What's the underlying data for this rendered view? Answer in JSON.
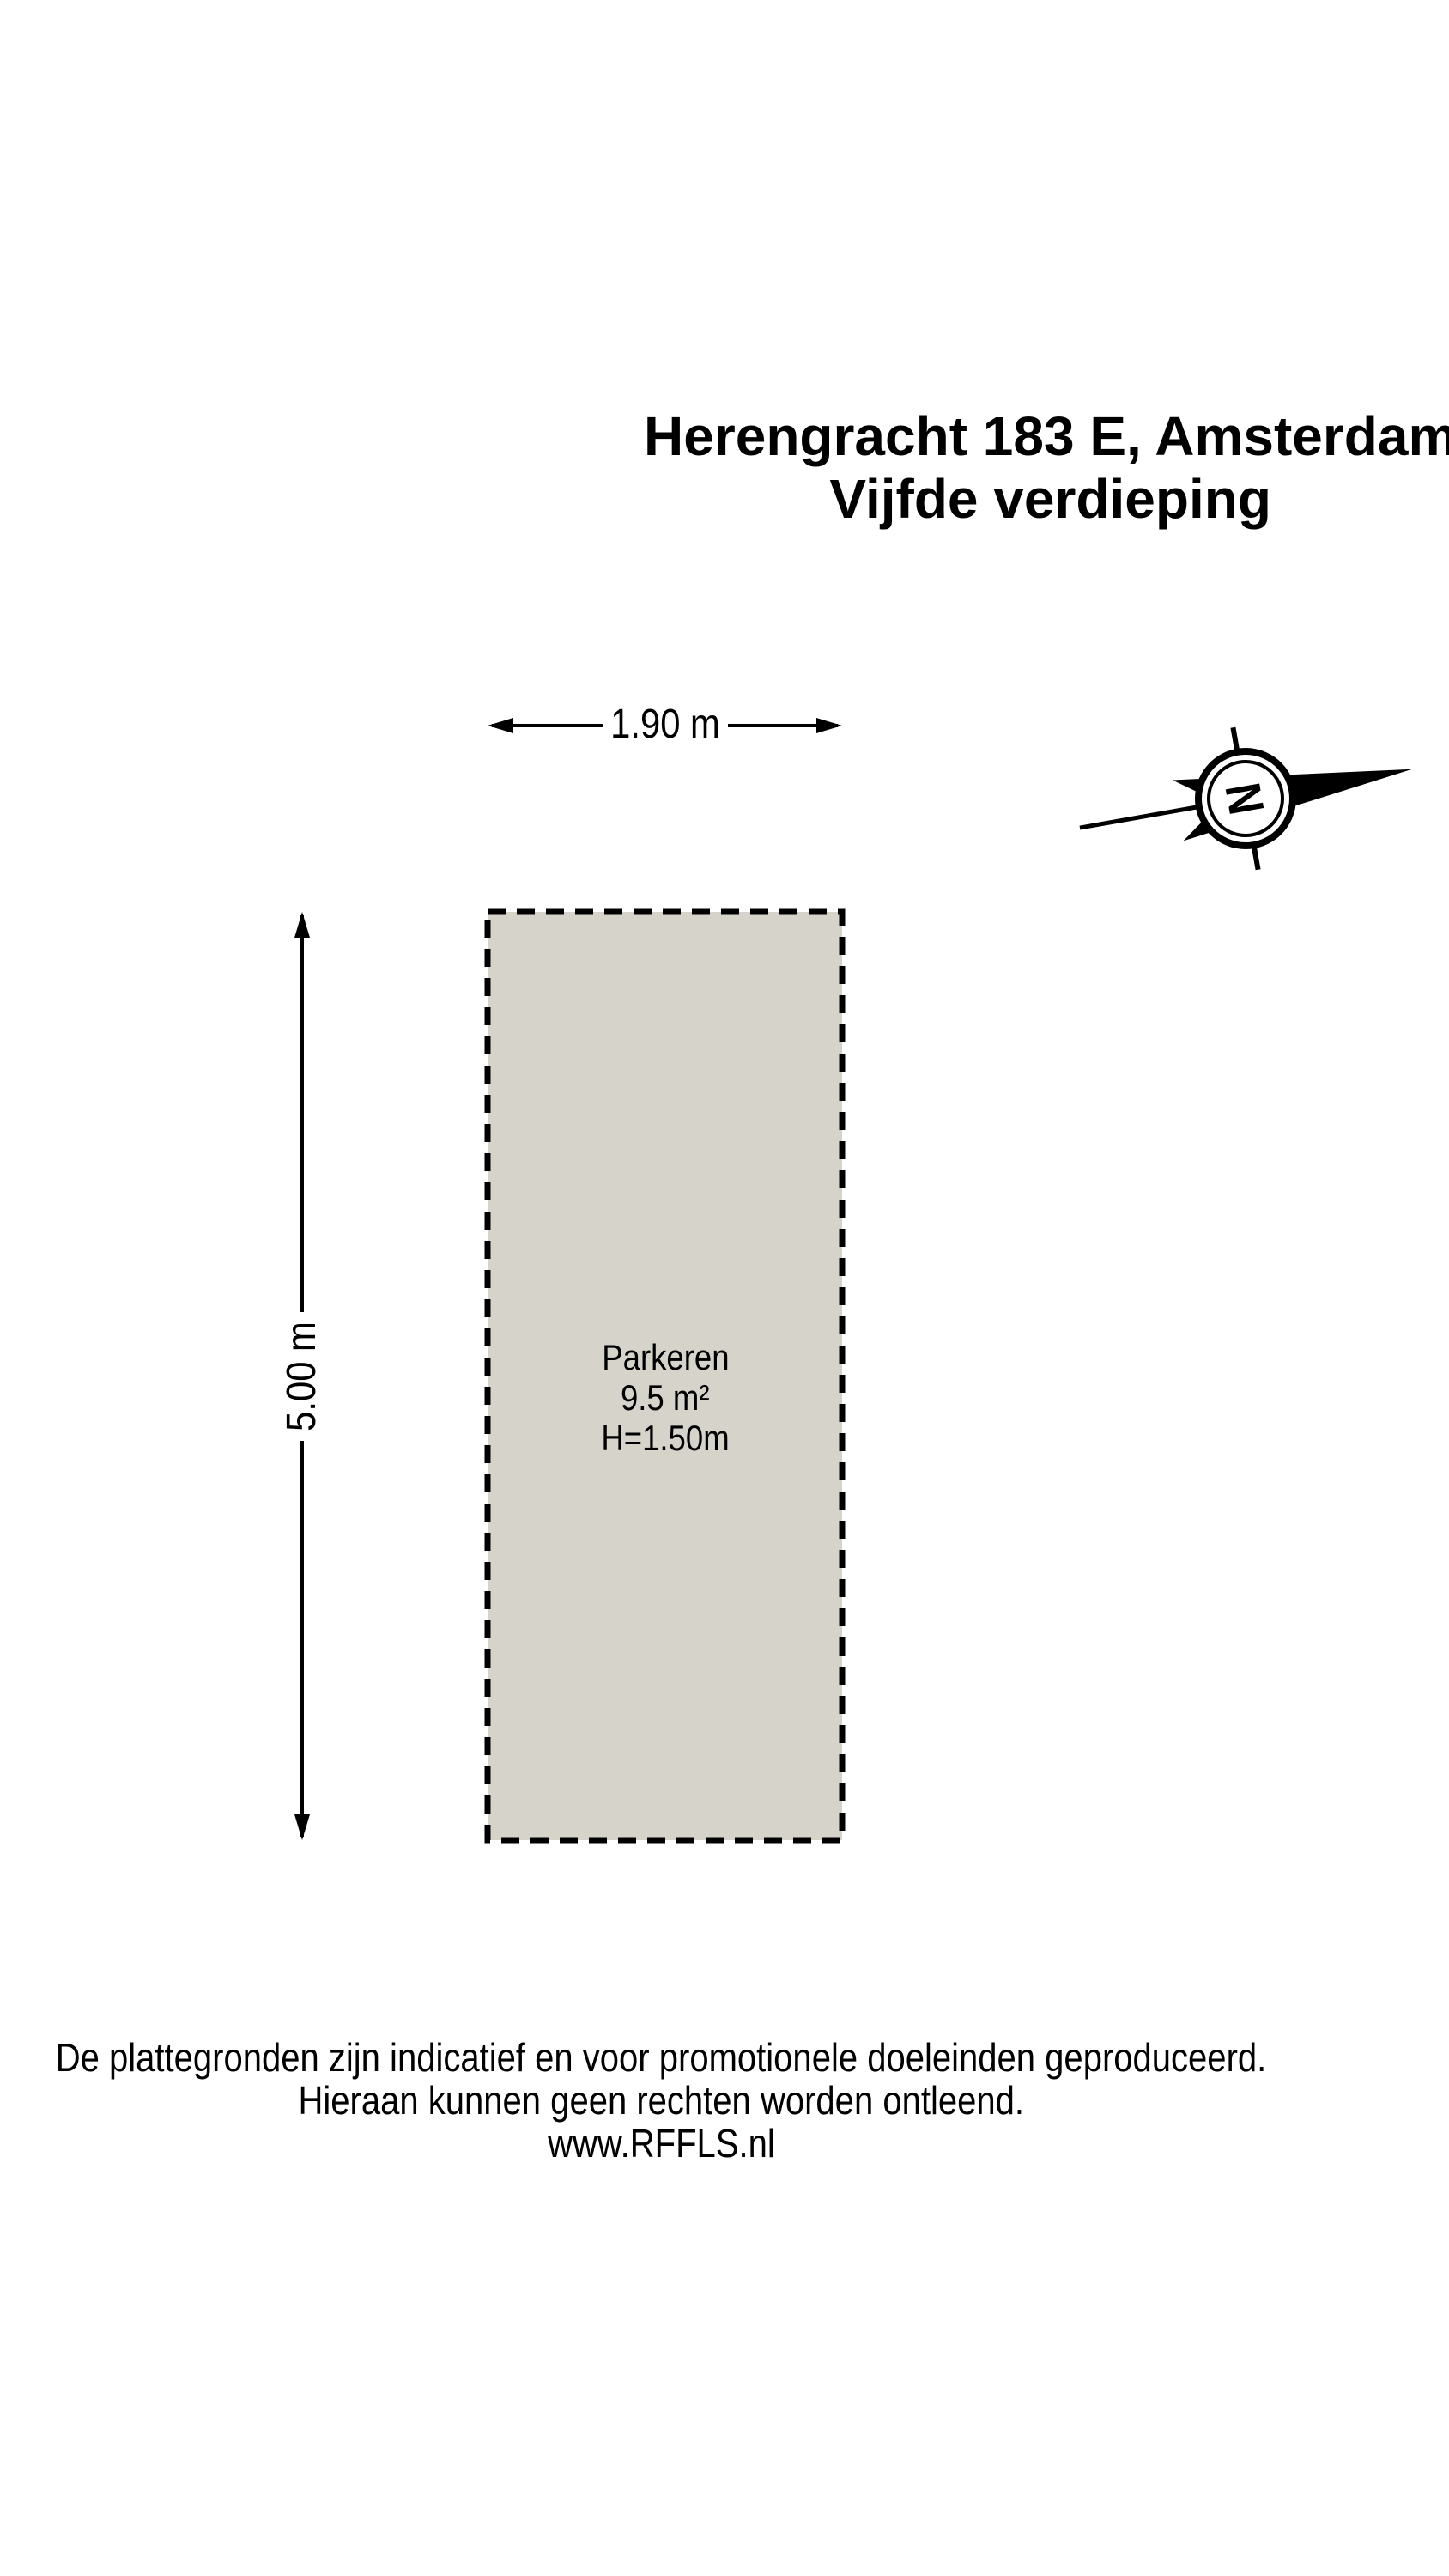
{
  "title": {
    "line1": "Herengracht 183 E, Amsterdam",
    "line2": "Vijfde verdieping"
  },
  "dimensions": {
    "width_label": "1.90 m",
    "height_label": "5.00 m"
  },
  "room": {
    "name": "Parkeren",
    "area": "9.5 m²",
    "ceiling_height": "H=1.50m"
  },
  "compass": {
    "letter": "N"
  },
  "footer": {
    "line1": "De plattegronden zijn indicatief en voor promotionele doeleinden geproduceerd.",
    "line2": "Hieraan kunnen geen rechten worden ontleend.",
    "line3": "www.RFFLS.nl"
  },
  "colors": {
    "room_fill": "#d6d3cb",
    "line": "#000000"
  }
}
